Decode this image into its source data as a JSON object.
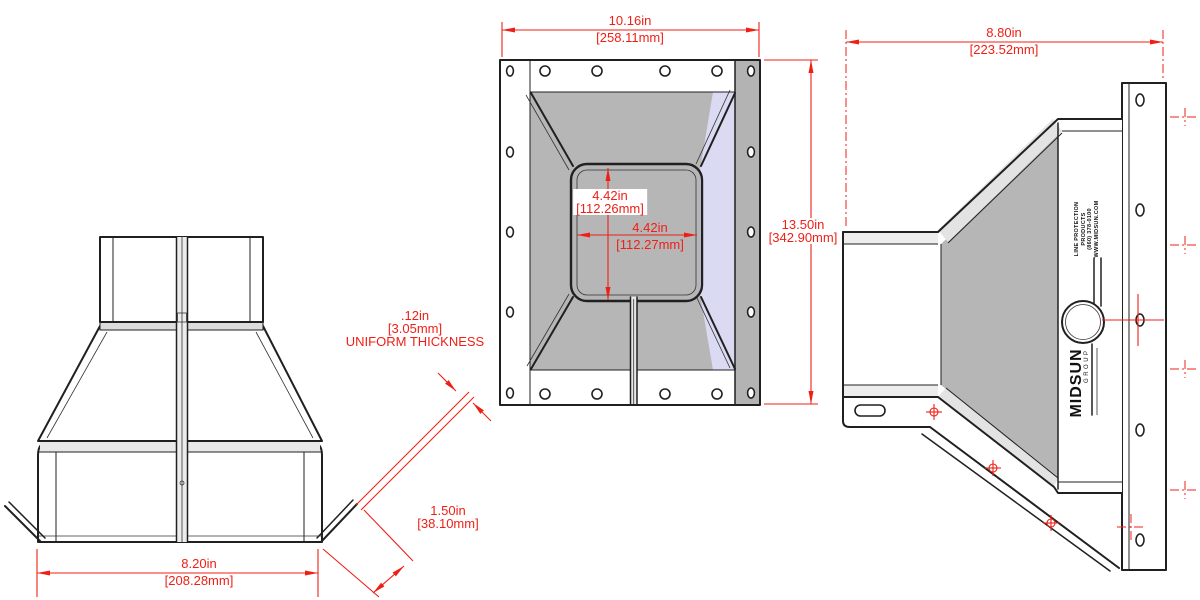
{
  "dims": {
    "front_width": {
      "in": "10.16in",
      "mm": "[258.11mm]"
    },
    "side_depth": {
      "in": "8.80in",
      "mm": "[223.52mm]"
    },
    "front_height": {
      "in": "13.50in",
      "mm": "[342.90mm]"
    },
    "inner_height": {
      "in": "4.42in",
      "mm": "[112.26mm]"
    },
    "inner_width": {
      "in": "4.42in",
      "mm": "[112.27mm]"
    },
    "thickness": {
      "in": ".12in",
      "mm": "[3.05mm]",
      "note": "UNIFORM THICKNESS"
    },
    "foot_width": {
      "in": "1.50in",
      "mm": "[38.10mm]"
    },
    "base_width": {
      "in": "8.20in",
      "mm": "[208.28mm]"
    }
  },
  "branding": {
    "logo_primary": "MIDSUN",
    "logo_secondary": "GROUP",
    "face_text_line1": "LINE PROTECTION",
    "face_text_line2": "PRODUCTS",
    "face_text_line3": "(860) 378-0100",
    "face_text_line4": "WWW.MIDSUN.COM"
  },
  "colors": {
    "dimension_red": "#ef1f16",
    "shade_gray": "#b5b5b5",
    "shade_lavender": "#dadaf2",
    "line_black": "#202020"
  }
}
